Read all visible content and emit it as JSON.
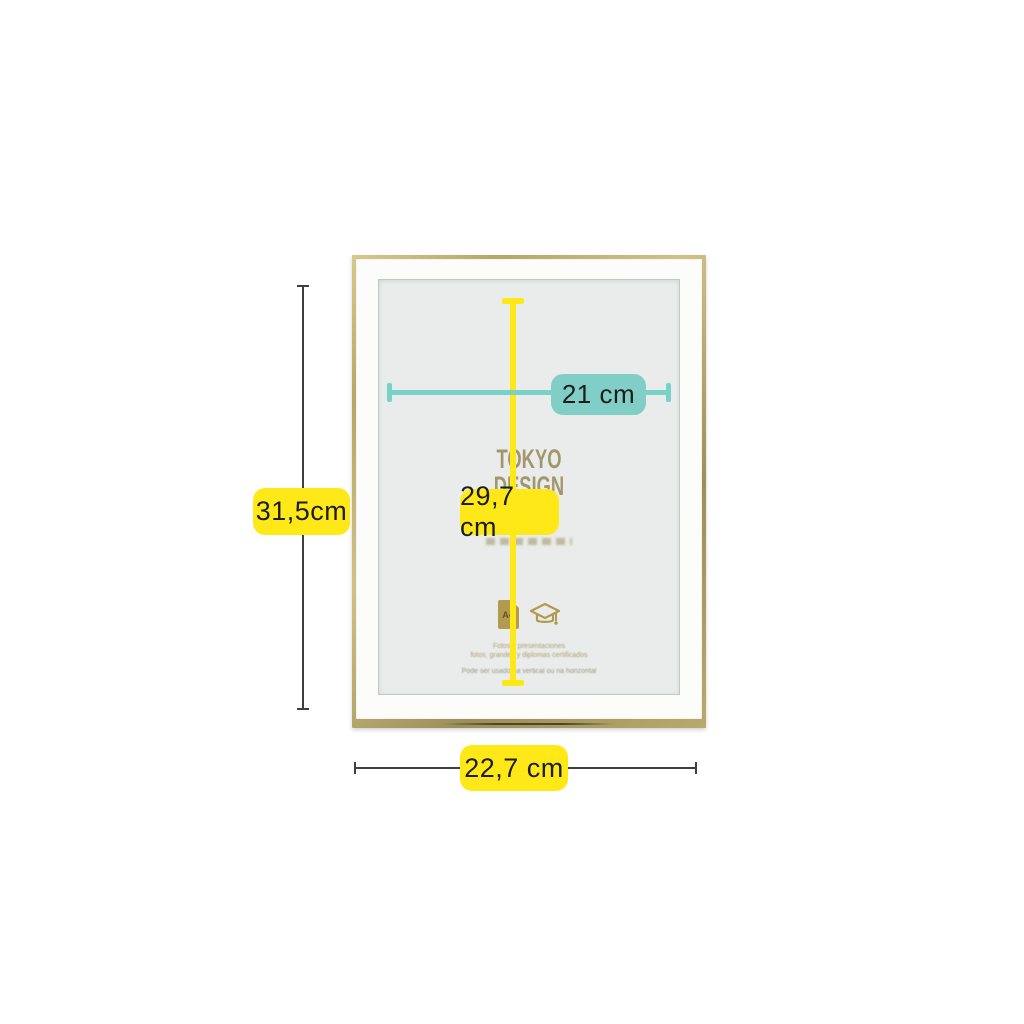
{
  "product": {
    "type": "picture-frame-dimension-diagram",
    "frame_style": "thin gold metal frame with white mat"
  },
  "frame": {
    "brand_line1": "TOKYO",
    "brand_line2": "DESIGN",
    "a4_icon_label": "A4",
    "caption_line1": "Fotos y presentaciones",
    "caption_line2": "fotos, grandes y diplomas certificados",
    "caption_line3": "Pode ser usado na vertical ou na horizontal"
  },
  "dimensions": {
    "inner_width_label": "21 cm",
    "inner_height_label": "29,7 cm",
    "outer_height_label": "31,5cm",
    "outer_width_label": "22,7 cm"
  },
  "colors": {
    "accent_yellow": "#ffe817",
    "accent_teal": "#80cec6",
    "teal_line": "#79d2c8",
    "frame_gold": "#b0a266",
    "dimension_line": "#3f3f3f",
    "mat_white": "#fcfcfb",
    "glass_grey": "#e9eceb",
    "brand_gold": "#a2966c",
    "background": "#ffffff"
  }
}
